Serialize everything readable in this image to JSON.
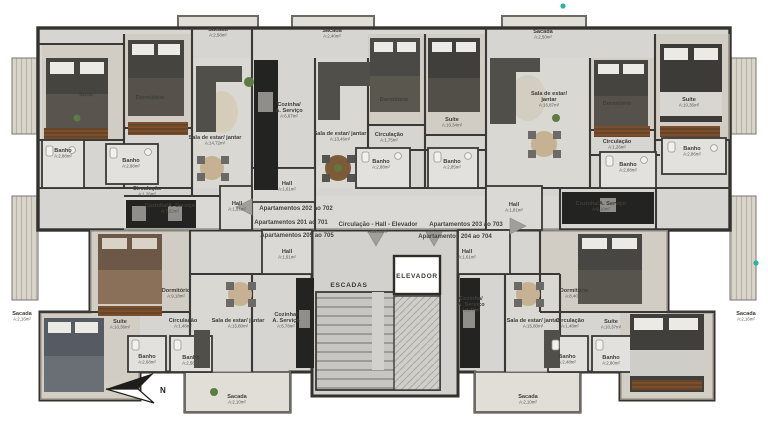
{
  "plan": {
    "corridor": {
      "title": "Circulação - Hall - Elevador",
      "area": "A:32,44m²",
      "x": 378,
      "y": 224
    },
    "core": {
      "stairs": "ESCADAS",
      "elevator": "ELEVADOR"
    },
    "compass": {
      "north": "N"
    },
    "colors": {
      "wall": "#33322e",
      "floor": "#d6d5d1",
      "accent_teal": "#2ab3a2"
    },
    "apartment_labels": [
      {
        "text": "Apartamentos 202 ao 702",
        "x": 296,
        "y": 210
      },
      {
        "text": "Apartamentos 201 ao 701",
        "x": 291,
        "y": 224
      },
      {
        "text": "Apartamentos 205 ao 705",
        "x": 297,
        "y": 237
      },
      {
        "text": "Apartamentos 203 ao 703",
        "x": 466,
        "y": 226
      },
      {
        "text": "Apartamentos 204 ao 704",
        "x": 455,
        "y": 238
      }
    ],
    "room_labels": [
      {
        "n": "Sacada",
        "a": "A:2,58m²",
        "x": 218,
        "y": 31
      },
      {
        "n": "Sacada",
        "a": "A:2,40m²",
        "x": 332,
        "y": 32
      },
      {
        "n": "Sacada",
        "a": "A:2,50m²",
        "x": 543,
        "y": 33
      },
      {
        "n": "Suíte",
        "a": "A:10,36m²",
        "x": 86,
        "y": 96
      },
      {
        "n": "Dormitório",
        "a": "A:9,16m²",
        "x": 150,
        "y": 99
      },
      {
        "n": "Sala de estar/ jantar",
        "a": "A:14,72m²",
        "x": 215,
        "y": 139
      },
      {
        "n": "Banho",
        "a": "A:2,88m²",
        "x": 63,
        "y": 152
      },
      {
        "n": "Banho",
        "a": "A:2,88m²",
        "x": 131,
        "y": 162
      },
      {
        "n": "Circulação",
        "a": "A:1,26m²",
        "x": 147,
        "y": 190
      },
      {
        "n": "Cozinha/A. Serviço",
        "a": "A:7,62m²",
        "x": 170,
        "y": 207
      },
      {
        "n": "Hall",
        "a": "A:1,81m²",
        "x": 237,
        "y": 205
      },
      {
        "n": "Cozinha/|A. Serviço",
        "a": "A:6,87m²",
        "x": 289,
        "y": 106
      },
      {
        "n": "Sala de estar/ jantar",
        "a": "A:13,46m²",
        "x": 340,
        "y": 135
      },
      {
        "n": "Dormitório",
        "a": "A:7,08m²",
        "x": 394,
        "y": 101
      },
      {
        "n": "Circulação",
        "a": "A:1,75m²",
        "x": 389,
        "y": 136
      },
      {
        "n": "Banho",
        "a": "A:2,88m²",
        "x": 381,
        "y": 163
      },
      {
        "n": "Hall",
        "a": "A:1,61m²",
        "x": 287,
        "y": 185
      },
      {
        "n": "Suíte",
        "a": "A:10,34m²",
        "x": 452,
        "y": 121
      },
      {
        "n": "Banho",
        "a": "A:2,85m²",
        "x": 452,
        "y": 163
      },
      {
        "n": "Sala de estar/|jantar",
        "a": "A:16,87m²",
        "x": 549,
        "y": 95
      },
      {
        "n": "Dormitório",
        "a": "A:9,16m²",
        "x": 617,
        "y": 105
      },
      {
        "n": "Suíte",
        "a": "A:10,36m²",
        "x": 689,
        "y": 101
      },
      {
        "n": "Circulação",
        "a": "A:1,26m²",
        "x": 617,
        "y": 143
      },
      {
        "n": "Banho",
        "a": "A:2,86m²",
        "x": 692,
        "y": 150
      },
      {
        "n": "Banho",
        "a": "A:2,88m²",
        "x": 628,
        "y": 166
      },
      {
        "n": "Cozinha/A. Serviço",
        "a": "A:9,10m²",
        "x": 601,
        "y": 205
      },
      {
        "n": "Hall",
        "a": "A:1,81m²",
        "x": 514,
        "y": 206
      },
      {
        "n": "Hall",
        "a": "A:1,61m²",
        "x": 287,
        "y": 253
      },
      {
        "n": "Hall",
        "a": "A:1,61m²",
        "x": 467,
        "y": 253
      },
      {
        "n": "Dormitório",
        "a": "A:9,18m²",
        "x": 176,
        "y": 292
      },
      {
        "n": "Dormitório",
        "a": "A:8,40m²",
        "x": 574,
        "y": 292
      },
      {
        "n": "Suíte",
        "a": "A:10,36m²",
        "x": 120,
        "y": 323
      },
      {
        "n": "Circulação",
        "a": "A:1,48m²",
        "x": 183,
        "y": 322
      },
      {
        "n": "Sala de estar/ jantar",
        "a": "A:15,80m²",
        "x": 238,
        "y": 322
      },
      {
        "n": "Cozinha/|A. Serviço",
        "a": "A:6,78m²",
        "x": 286,
        "y": 316
      },
      {
        "n": "Cozinha/|A. Serviço",
        "a": "A:6,78m²",
        "x": 471,
        "y": 300
      },
      {
        "n": "Sala de estar/ jantar",
        "a": "A:15,80m²",
        "x": 533,
        "y": 322
      },
      {
        "n": "Circulação",
        "a": "A:1,48m²",
        "x": 570,
        "y": 322
      },
      {
        "n": "Suíte",
        "a": "A:10,37m²",
        "x": 611,
        "y": 323
      },
      {
        "n": "Banho",
        "a": "A:2,68m²",
        "x": 147,
        "y": 358
      },
      {
        "n": "Banho",
        "a": "A:2,58m²",
        "x": 191,
        "y": 359
      },
      {
        "n": "Banho",
        "a": "A:2,48m²",
        "x": 567,
        "y": 358
      },
      {
        "n": "Banho",
        "a": "A:2,80m²",
        "x": 611,
        "y": 359
      },
      {
        "n": "Sacada",
        "a": "A:2,10m²",
        "x": 237,
        "y": 398
      },
      {
        "n": "Sacada",
        "a": "A:2,10m²",
        "x": 528,
        "y": 398
      },
      {
        "n": "Sacada",
        "a": "A:2,16m²",
        "x": 22,
        "y": 315
      },
      {
        "n": "Sacada",
        "a": "A:2,16m²",
        "x": 746,
        "y": 315
      }
    ]
  }
}
